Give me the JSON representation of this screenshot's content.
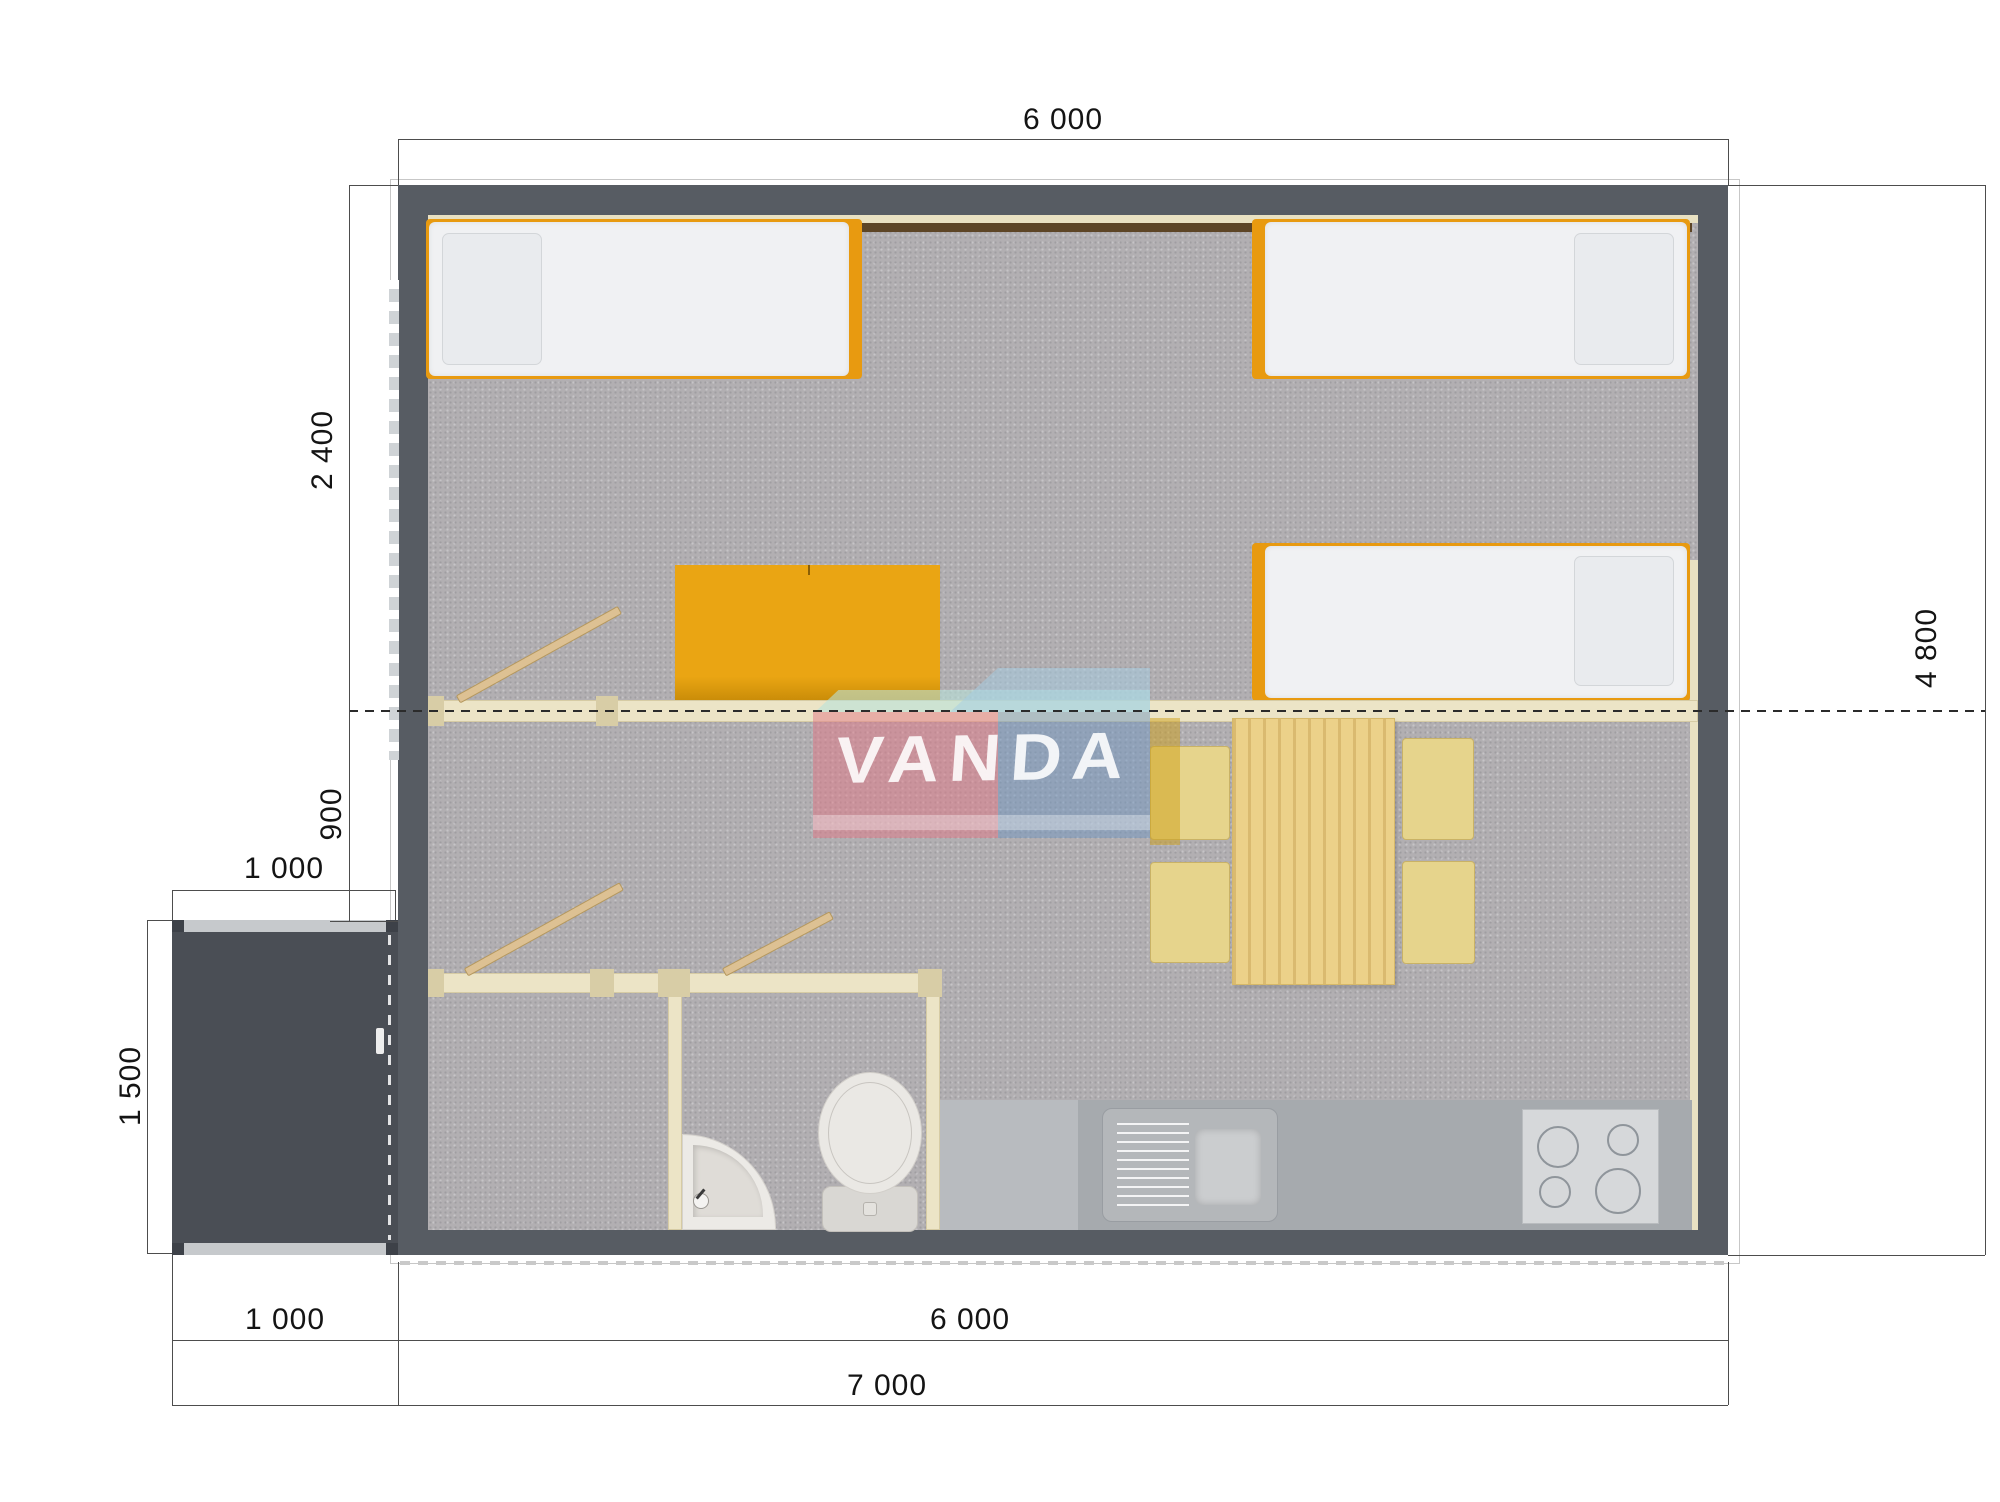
{
  "watermark": {
    "text": "VANDA"
  },
  "dimensions": {
    "top_width": "6 000",
    "building_height": "4 800",
    "bedroom_depth": "2 400",
    "hall_depth": "900",
    "porch_width": "1 000",
    "porch_depth": "1 500",
    "porch_width_bottom": "1 000",
    "building_width_bottom": "6 000",
    "total_width": "7 000"
  },
  "colors": {
    "wall": "#575c63",
    "porch_floor": "#4a4e55",
    "carpet": "#b2afb2",
    "partition": "#ece4c6",
    "accent_orange": "#e89a10",
    "wood": "#ecd189",
    "counter": "#a6aaae",
    "dimension_line": "#4d4d4d",
    "watermark_pink": "#e27886",
    "watermark_blue": "#6c94c1",
    "watermark_teal": "#b9e2db"
  }
}
